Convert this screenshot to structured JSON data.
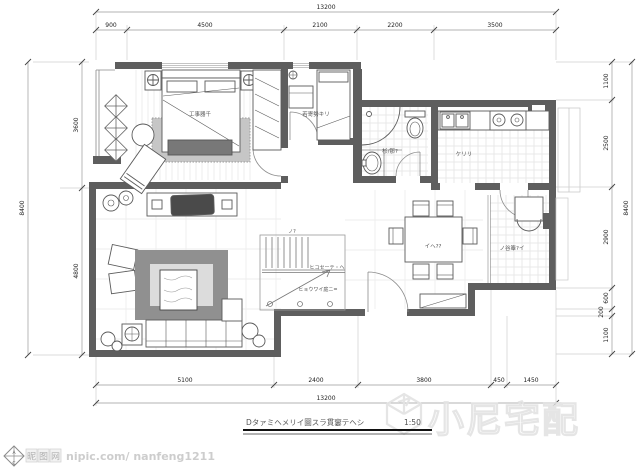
{
  "drawing": {
    "title": "Dタァミヘメリイ圖スラ貫窶テヘシ",
    "scale": "1:50",
    "dims": {
      "top": {
        "overall": "13200",
        "segments": [
          "900",
          "4500",
          "2100",
          "2200",
          "3500"
        ]
      },
      "bottom": {
        "overall": "13200",
        "segments": [
          "5100",
          "2400",
          "3800",
          "450",
          "1450"
        ]
      },
      "left": {
        "overall": "8400",
        "segments": [
          "3600",
          "4800"
        ]
      },
      "right": {
        "overall": "8400",
        "segments": [
          "1100",
          "2500",
          "2900",
          "600",
          "200",
          "1100"
        ]
      }
    },
    "rooms": {
      "master": "工事器千",
      "bedroom2": "若寄勢キリ",
      "bath": "杉/那?",
      "kitchen": "ケリリ",
      "dining": "イヘ??",
      "utility": "ノ谷簟?イ",
      "stairs1": "ヒコセーテ・ヘ",
      "stairs2": "ヒョウワイ庭ニ=",
      "stairs_note": "ノ?"
    }
  },
  "watermarks": {
    "nipic": {
      "logo_top": "A",
      "logo_bottom": "C",
      "site": "昵图网",
      "account": "nipic.com/ nanfeng1211"
    },
    "brand": "小尼宅配"
  }
}
